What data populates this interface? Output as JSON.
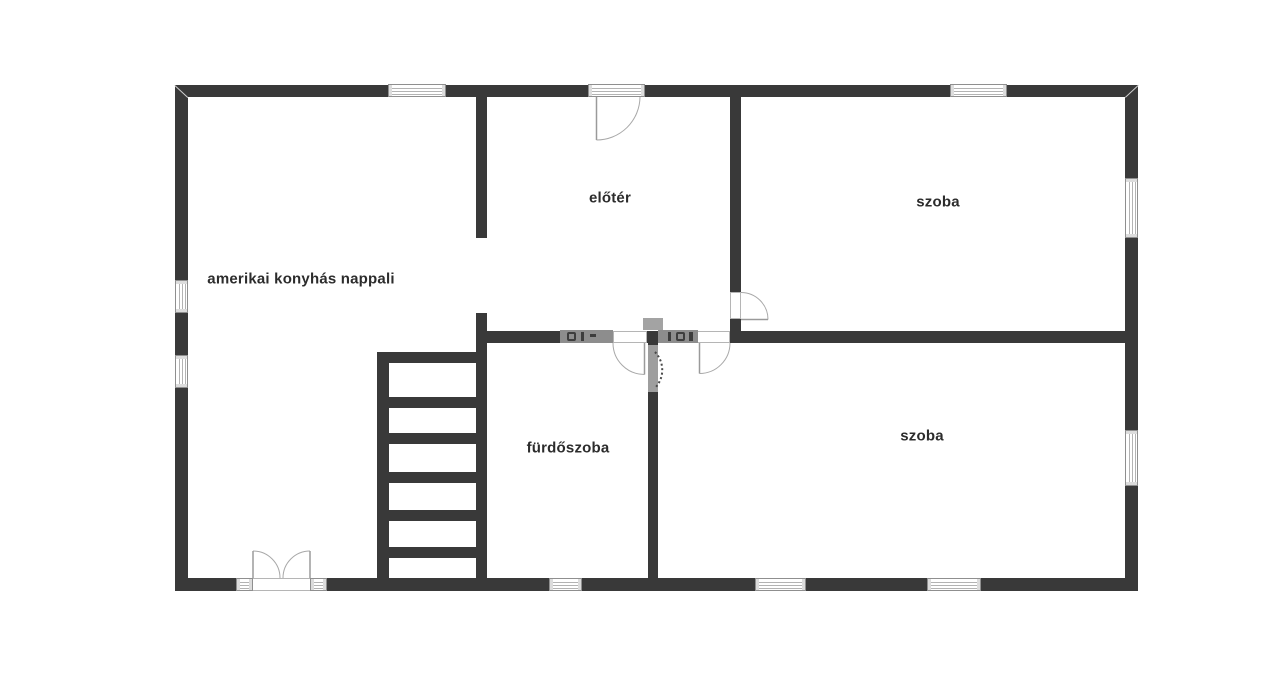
{
  "meta": {
    "canvas_width": 1280,
    "canvas_height": 681,
    "background": "#ffffff"
  },
  "colors": {
    "wall": "#393939",
    "door_swing_line": "#a8a8a8",
    "door_leaf_line": "#9a9a9a",
    "window_frame": "#8f8f8f",
    "label_text": "#2c2c2c",
    "watermark_gray": "#8d8d8d"
  },
  "rooms": [
    {
      "id": "living-room",
      "text": "amerikai konyhás nappali",
      "x": 301,
      "y": 279
    },
    {
      "id": "foyer",
      "text": "előtér",
      "x": 610,
      "y": 198
    },
    {
      "id": "room-1",
      "text": "szoba",
      "x": 938,
      "y": 202
    },
    {
      "id": "room-2",
      "text": "szoba",
      "x": 922,
      "y": 436
    },
    {
      "id": "bathroom",
      "text": "fürdőszoba",
      "x": 568,
      "y": 448
    }
  ],
  "plan": {
    "walls": [
      {
        "name": "outer-wall-top",
        "x": 175,
        "y": 85,
        "w": 963,
        "h": 12
      },
      {
        "name": "outer-wall-bottom",
        "x": 175,
        "y": 578,
        "w": 963,
        "h": 13
      },
      {
        "name": "outer-wall-left",
        "x": 175,
        "y": 85,
        "w": 13,
        "h": 506
      },
      {
        "name": "outer-wall-right",
        "x": 1125,
        "y": 85,
        "w": 13,
        "h": 506
      },
      {
        "name": "inner-wall-livingroom-foyer-upper",
        "x": 476,
        "y": 97,
        "w": 11,
        "h": 141
      },
      {
        "name": "inner-wall-stair-bathroom",
        "x": 476,
        "y": 313,
        "w": 11,
        "h": 265
      },
      {
        "name": "inner-wall-foyer-room1",
        "x": 730,
        "y": 97,
        "w": 11,
        "h": 195
      },
      {
        "name": "inner-wall-foyer-room1-stub",
        "x": 730,
        "y": 319,
        "w": 11,
        "h": 24
      },
      {
        "name": "inner-wall-horizontal-seg1",
        "x": 487,
        "y": 331,
        "w": 126,
        "h": 12
      },
      {
        "name": "inner-wall-horizontal-seg2",
        "x": 647,
        "y": 331,
        "w": 50,
        "h": 12
      },
      {
        "name": "inner-wall-horizontal-seg3",
        "x": 730,
        "y": 331,
        "w": 395,
        "h": 12
      },
      {
        "name": "inner-wall-bathroom-room2",
        "x": 648,
        "y": 343,
        "w": 10,
        "h": 235
      }
    ],
    "stairs": {
      "rail": {
        "x": 377,
        "y": 352,
        "w": 12,
        "h": 226
      },
      "treads": [
        {
          "x": 377,
          "y": 352,
          "w": 110,
          "h": 11
        },
        {
          "x": 377,
          "y": 397,
          "w": 110,
          "h": 11
        },
        {
          "x": 377,
          "y": 433,
          "w": 110,
          "h": 11
        },
        {
          "x": 377,
          "y": 472,
          "w": 110,
          "h": 11
        },
        {
          "x": 377,
          "y": 510,
          "w": 110,
          "h": 11
        },
        {
          "x": 377,
          "y": 547,
          "w": 110,
          "h": 11
        }
      ]
    },
    "windows": [
      {
        "name": "window-top-left",
        "o": "h",
        "x": 388,
        "y": 84,
        "w": 58,
        "h": 13
      },
      {
        "name": "entry-door-glazing",
        "o": "h",
        "x": 588,
        "y": 84,
        "w": 57,
        "h": 13
      },
      {
        "name": "window-top-right",
        "o": "h",
        "x": 950,
        "y": 84,
        "w": 57,
        "h": 13
      },
      {
        "name": "window-bottom-bathroom",
        "o": "h",
        "x": 549,
        "y": 578,
        "w": 33,
        "h": 13
      },
      {
        "name": "window-bottom-room2-left",
        "o": "h",
        "x": 755,
        "y": 578,
        "w": 51,
        "h": 13
      },
      {
        "name": "window-bottom-room2-right",
        "o": "h",
        "x": 927,
        "y": 578,
        "w": 54,
        "h": 13
      },
      {
        "name": "window-left-upper",
        "o": "v",
        "x": 175,
        "y": 280,
        "w": 13,
        "h": 33
      },
      {
        "name": "window-left-lower",
        "o": "v",
        "x": 175,
        "y": 355,
        "w": 13,
        "h": 33
      },
      {
        "name": "window-right-room1",
        "o": "v",
        "x": 1125,
        "y": 178,
        "w": 13,
        "h": 60
      },
      {
        "name": "window-right-room2",
        "o": "v",
        "x": 1125,
        "y": 430,
        "w": 13,
        "h": 56
      },
      {
        "name": "french-door-frame-left",
        "o": "h",
        "x": 236,
        "y": 578,
        "w": 17,
        "h": 13
      },
      {
        "name": "french-door-frame-right",
        "o": "h",
        "x": 310,
        "y": 578,
        "w": 17,
        "h": 13
      }
    ],
    "door_gaps": [
      {
        "name": "french-door-opening",
        "x": 236,
        "y": 578,
        "w": 91,
        "h": 13
      },
      {
        "name": "bathroom-door-opening",
        "x": 613,
        "y": 331,
        "w": 34,
        "h": 12
      },
      {
        "name": "room2-door-opening",
        "x": 697,
        "y": 331,
        "w": 33,
        "h": 12
      },
      {
        "name": "room1-door-opening",
        "x": 730,
        "y": 292,
        "w": 11,
        "h": 27
      }
    ],
    "doors": [
      {
        "name": "entry-door",
        "leaf": [
          596.5,
          97,
          596.5,
          140
        ],
        "arc": "M596.5 140 A43.5 43.5 0 0 0 640 97"
      },
      {
        "name": "french-door-left",
        "leaf": [
          253,
          551,
          253,
          578
        ],
        "arc": "M253 551 A27 27 0 0 1 280 578"
      },
      {
        "name": "french-door-right",
        "leaf": [
          310,
          551,
          310,
          578
        ],
        "arc": "M310 551 A27 27 0 0 0 283 578"
      },
      {
        "name": "bathroom-door",
        "leaf": [
          644.5,
          343,
          644.5,
          374.5
        ],
        "arc": "M613 343 A31.5 31.5 0 0 0 644.5 374.5"
      },
      {
        "name": "room2-door",
        "leaf": [
          699.5,
          343,
          699.5,
          373.5
        ],
        "arc": "M730 343 A30.5 30.5 0 0 1 699.5 373.5"
      },
      {
        "name": "room1-door",
        "leaf": [
          741,
          319.5,
          768,
          319.5
        ],
        "arc": "M741 292.5 A27 27 0 0 1 768 319.5"
      }
    ],
    "watermark": {
      "rects": [
        {
          "x": 560,
          "y": 330,
          "w": 53,
          "h": 13,
          "bg": "#8d8d8d"
        },
        {
          "x": 658,
          "y": 330,
          "w": 40,
          "h": 13,
          "bg": "#8d8d8d"
        },
        {
          "x": 643,
          "y": 318,
          "w": 20,
          "h": 12,
          "bg": "#a3a3a3"
        },
        {
          "x": 648,
          "y": 345,
          "w": 10,
          "h": 47,
          "bg": "#9e9e9e"
        }
      ],
      "marks": [
        {
          "x": 567,
          "y": 332,
          "w": 9,
          "h": 9,
          "ring": true
        },
        {
          "x": 581,
          "y": 332,
          "w": 3,
          "h": 9,
          "bg": "#3d3d3d"
        },
        {
          "x": 590,
          "y": 334,
          "w": 6,
          "h": 3,
          "bg": "#3d3d3d"
        },
        {
          "x": 676,
          "y": 332,
          "w": 9,
          "h": 9,
          "ring": true
        },
        {
          "x": 668,
          "y": 332,
          "w": 3,
          "h": 9,
          "bg": "#3d3d3d"
        },
        {
          "x": 689,
          "y": 332,
          "w": 4,
          "h": 9,
          "bg": "#3d3d3d"
        }
      ],
      "arc": "M655 352 A26 26 0 0 1 655 388"
    },
    "miters": [
      {
        "x": 175,
        "y": 85,
        "len": 17.6,
        "angle": 42.7
      },
      {
        "x": 1125,
        "y": 97,
        "len": 17.7,
        "angle": -42.7
      }
    ]
  }
}
